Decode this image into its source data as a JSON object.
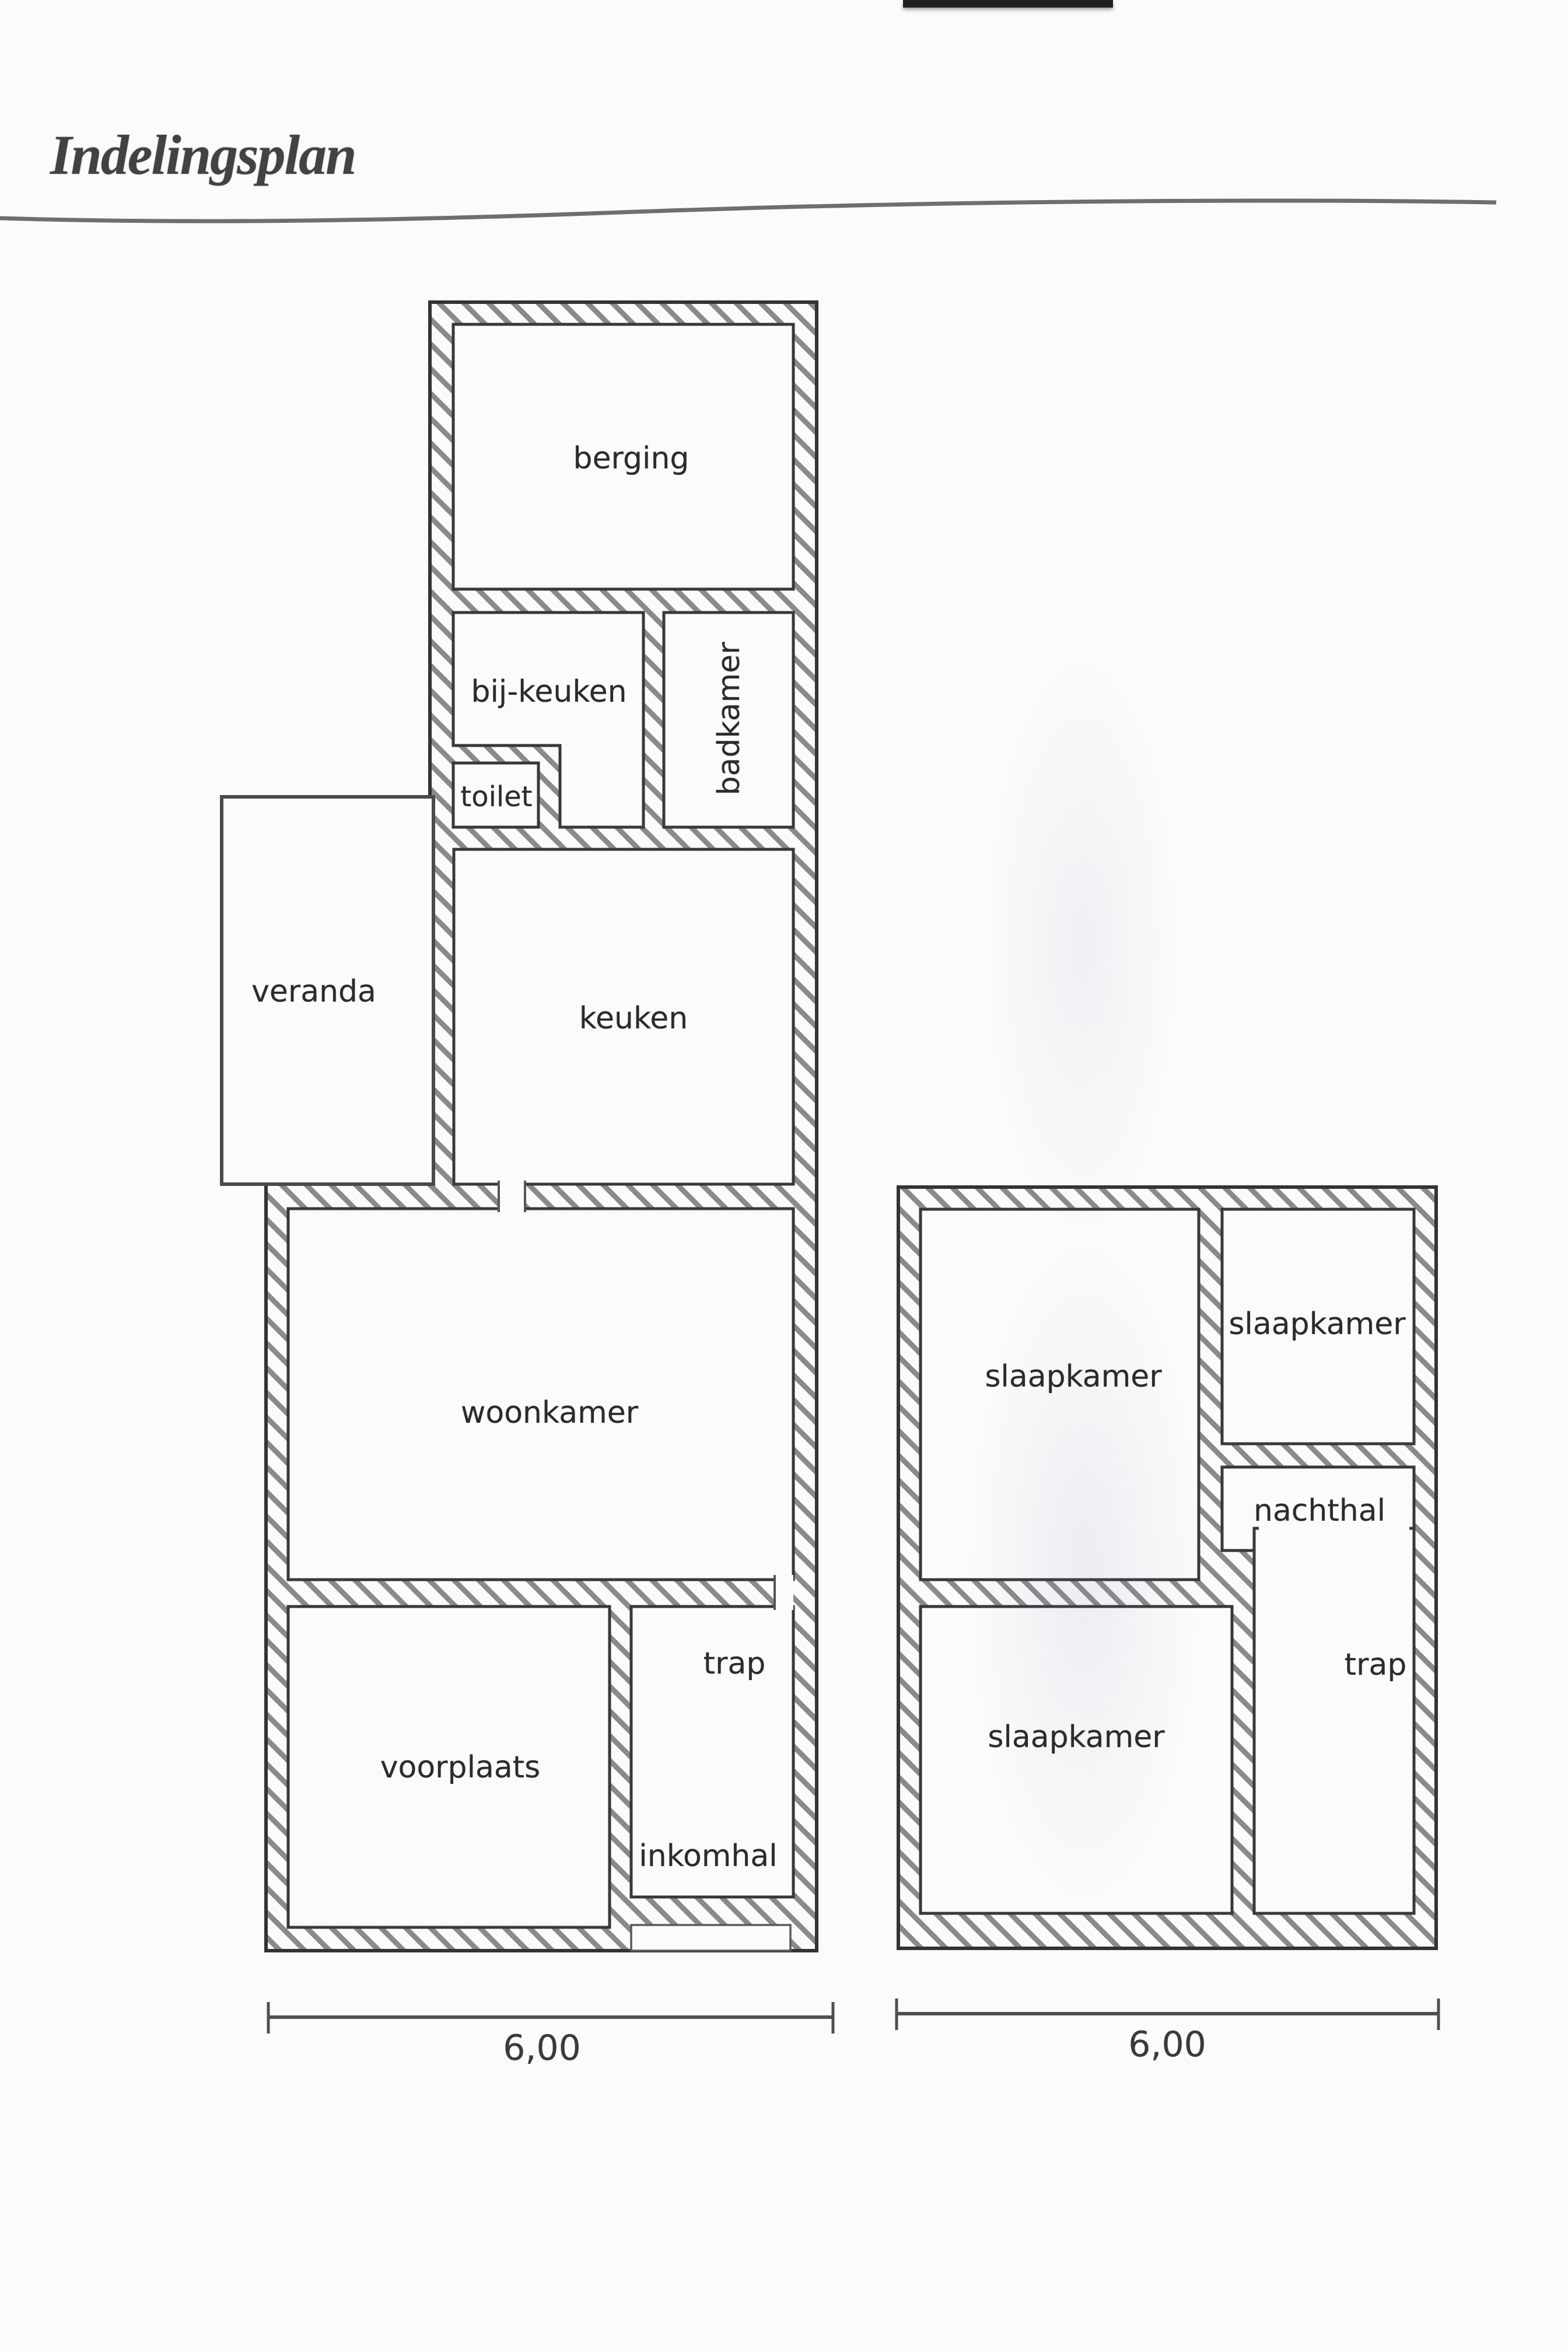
{
  "title": "Indelingsplan",
  "ground_floor": {
    "rooms": {
      "berging": "berging",
      "bij_keuken": "bij-keuken",
      "toilet": "toilet",
      "badkamer": "badkamer",
      "veranda": "veranda",
      "keuken": "keuken",
      "woonkamer": "woonkamer",
      "voorplaats": "voorplaats",
      "trap": "trap",
      "inkomhal": "inkomhal"
    },
    "width_dimension": "6,00"
  },
  "upper_floor": {
    "rooms": {
      "slaapkamer_front": "slaapkamer",
      "slaapkamer_small": "slaapkamer",
      "nachthal": "nachthal",
      "slaapkamer_back": "slaapkamer",
      "trap": "trap"
    },
    "width_dimension": "6,00"
  }
}
